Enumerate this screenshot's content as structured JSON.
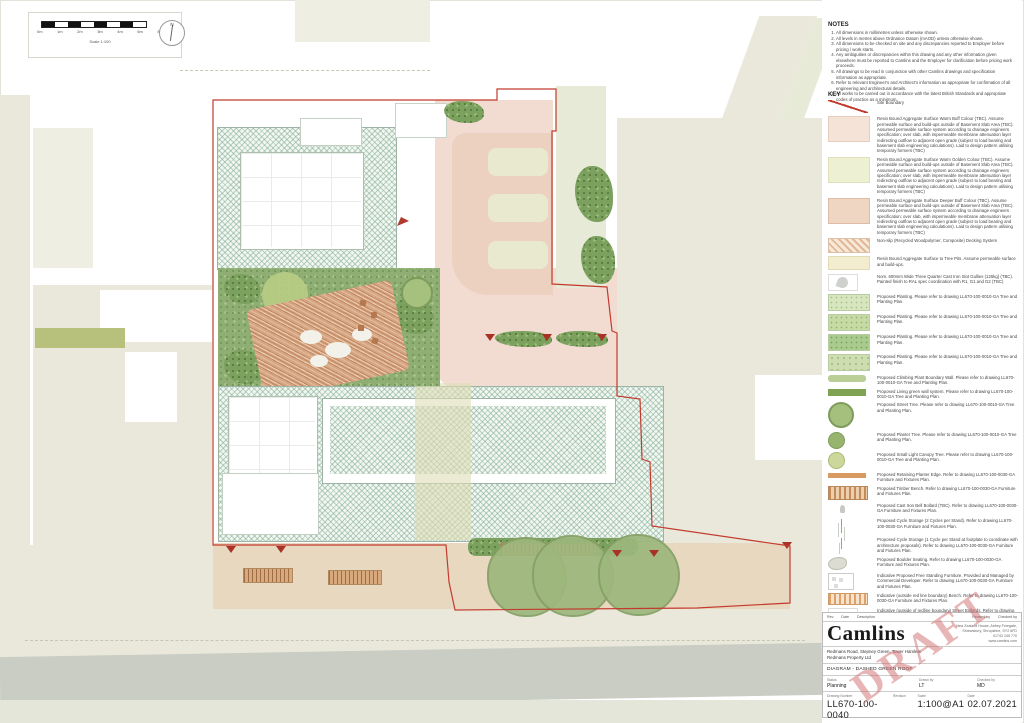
{
  "scalebar": {
    "labels": [
      "0m",
      "1m",
      "2m",
      "3m",
      "4m",
      "6m",
      "8m"
    ],
    "caption": "Scale  1:100",
    "north_letter": "N"
  },
  "notes": {
    "heading": "NOTES",
    "items": [
      "All dimensions in millimetres unless otherwise shown.",
      "All levels in metres above Ordnance Datum (mAOD) unless otherwise shown.",
      "All dimensions to be checked on site and any discrepancies reported to Employer before pricing / work starts.",
      "Any ambiguities or discrepancies within this drawing and any other information given elsewhere must be reported to Camlins and the Employer for clarification before pricing work proceeds.",
      "All drawings to be read in conjunction with other Camlins drawings and specification information as appropriate.",
      "Refer to relevant Engineer's and Architect's information as appropriate for confirmation of all engineering and architectural details.",
      "All works to be carried out in accordance with the latest British Standards and appropriate codes of practice as a minimum."
    ]
  },
  "key": {
    "heading": "KEY",
    "items": [
      {
        "swatch": "site-line",
        "label": "Site Boundary"
      },
      {
        "swatch": "resin-buff",
        "label": "Resin Bound Aggregate Surface Warm Buff Colour (TBC). Assume permeable surface and build-ups outside of Basement Slab Area (TBC). Assumed permeable surface system according to drainage engineers specification; over slab, with impermeable membrane attenuation layer redirecting outflow to adjacent open grade (subject to load bearing and basement slab engineering calculations). Laid to design pattern utilising temporary formers (TBC)"
      },
      {
        "swatch": "resin-golden",
        "label": "Resin Bound Aggregate Surface Warm Golden Colour (TBC). Assume permeable surface and build-ups outside of Basement Slab Area (TBC). Assumed permeable surface system according to drainage engineers specification; over slab, with impermeable membrane attenuation layer redirecting outflow to adjacent open grade (subject to load bearing and basement slab engineering calculations). Laid to design pattern utilising temporary formers (TBC)"
      },
      {
        "swatch": "resin-deeper",
        "label": "Resin Bound Aggregate Surface Deeper Buff Colour (TBC). Assume permeable surface and build-ups outside of Basement Slab Area (TBC). Assumed permeable surface system according to drainage engineers specification; over slab, with impermeable membrane attenuation layer redirecting outflow to adjacent open grade (subject to load bearing and basement slab engineering calculations). Laid to design pattern utilising temporary formers (TBC)"
      },
      {
        "swatch": "decking",
        "label": "Non-slip (Recycled Woodpolymer, Composite) Decking System"
      },
      {
        "swatch": "tree-pit",
        "label": "Resin Bound Aggregate Surface to Tree Pits. Assume permeable surface and build-ups."
      },
      {
        "swatch": "gully",
        "label": "Nom. 600mm Wide Three Quarter Cast Iron Slot Gullies (125kg) (TBC). Painted finish to RAL spec coordination with R1, G1 and G2 (TBC)"
      },
      {
        "swatch": "plant-a",
        "label": "Proposed Planting.  Please refer to drawing LL670-100-0010-GA Tree and Planting Plan."
      },
      {
        "swatch": "plant-b",
        "label": "Proposed Planting.  Please refer to drawing LL670-100-0010-GA Tree and Planting Plan."
      },
      {
        "swatch": "plant-c",
        "label": "Proposed Planting.  Please refer to drawing LL670-100-0010-GA Tree and Planting Plan."
      },
      {
        "swatch": "plant-d",
        "label": "Proposed Planting.  Please refer to drawing LL670-100-0010-GA Tree and Planting Plan."
      },
      {
        "swatch": "climb-wall",
        "label": "Proposed Climbing Plant Boundary Wall.  Please refer to drawing LL670-100-0010-GA Tree and Planting Plan."
      },
      {
        "swatch": "living-wall",
        "label": "Proposed Living green wall system.  Please refer to drawing LL670-100-0010-GA Tree and Planting Plan."
      },
      {
        "swatch": "street-tree",
        "label": "Proposed Street Tree.  Please refer to drawing LL670-100-0010-GA Tree and Planting Plan."
      },
      {
        "swatch": "planter-tree",
        "label": "Proposed Planter Tree.  Please refer to drawing LL670-100-0010-GA Tree and Planting Plan."
      },
      {
        "swatch": "canopy-tree",
        "label": "Proposed Small Light Canopy Tree. Please refer to drawing LL670-100-0010-GA Tree and Planting Plan."
      },
      {
        "swatch": "planter-edge",
        "label": "Proposed Retaining Planter Edge. Refer to drawing LL670-100-0030-GA Furniture and Fixtures Plan."
      },
      {
        "swatch": "timber-bench",
        "label": "Proposed Timber Bench. Refer to drawing LL670-100-0030-GA Furniture and Fixtures Plan."
      },
      {
        "swatch": "bollard",
        "label": "Proposed Cast Iron Bell Bollard (TBC). Refer to drawing LL670-100-0030-GA Furniture and Fixtures Plan."
      },
      {
        "swatch": "cycle2",
        "label": "Proposed Cycle Storage (2 Cycles per Stand). Refer to drawing LL670-100-0030-GA Furniture and Fixtures Plan."
      },
      {
        "swatch": "cycle1",
        "label": "Proposed Cycle Storage (1 Cycle per Stand at footplate to coordinate with architecture proposals). Refer to drawing LL670-100-0030-GA Furniture and Fixtures Plan."
      },
      {
        "swatch": "boulder",
        "label": "Proposed Boulder Seating. Refer to drawing LL670-100-0030-GA Furniture and Fixtures Plan."
      },
      {
        "swatch": "free-furniture",
        "label": "Indicative Proposed Free Standing Furniture. Provided and Managed by Commercial Developer. Refer to drawing LL670-100-0030-GA Furniture and Fixtures Plan."
      },
      {
        "swatch": "ind-bench",
        "label": "Indicative (outside red line boundary) Bench. Refer to drawing LL670-100-0030-GA Furniture and Fixtures Plan."
      },
      {
        "swatch": "ind-bollard",
        "label": "Indicative (outside of redline boundary) Street Bollards. Refer to drawing LL670-100-0030-GA Furniture and Fixtures Plan."
      },
      {
        "swatch": "green-roof",
        "label": "Biodiverse / Extensive Green and Blue Roofs with Water Retention Layer. To be designed and installed in accordance with specialist green roof supplier specification."
      },
      {
        "swatch": "pv-panel",
        "label": "Photovoltaic Panel Area (size and spec TBC) with Biodiverse / Extensive Green Roof Beneath. To be designed and installed in accordance with specialist PV and green roof supplier specification."
      },
      {
        "swatch": "gravel-path",
        "label": "Loose gravel maintenance path.  Nom. 600mm wide."
      },
      {
        "swatch": "bluegreen-roof",
        "label": "Extent of Blue /  Green Roof"
      }
    ]
  },
  "titleblock": {
    "rev_header": {
      "rev": "Rev",
      "date": "Date",
      "description": "Description",
      "revised": "Revised by",
      "checked": "Checked by"
    },
    "logo": "Camlins",
    "address_lines": [
      "New Zealand House, Abbey Foregate,",
      "Shrewsbury, Shropshire, SY2 6FD",
      "01743 245 770",
      "www.camlins.com"
    ],
    "project_line1": "Redmans Road, Stepney Green, Tower Hamlets",
    "project_line2": "Redmans Property Ltd",
    "drawing_title": "DIAGRAM - DASHED GREEN ROOF",
    "fields": {
      "status_label": "Status",
      "status": "Planning",
      "drawn_label": "Drawn by",
      "drawn": "LT",
      "checked_label": "Checked by",
      "checked": "MD",
      "number_label": "Drawing Number",
      "number": "LL670-100-0040",
      "revision_label": "Revision",
      "revision": "",
      "scale_label": "Scale",
      "scale": "1:100@A1",
      "date_label": "Date",
      "date": "02.07.2021"
    },
    "watermark": "DRAFT"
  },
  "colors": {
    "boundary_red": "#c23b2e",
    "marker_red": "#a93226",
    "draft_pink": "#cf6c6c",
    "green_roof_hatch": "#78a88c",
    "planting_green": "#8fae74",
    "resin_pink": "#f2dcd2",
    "deck_orange": "#d9a57e",
    "context_olive": "#e9e8da",
    "road_grey": "#c9cdc4"
  }
}
